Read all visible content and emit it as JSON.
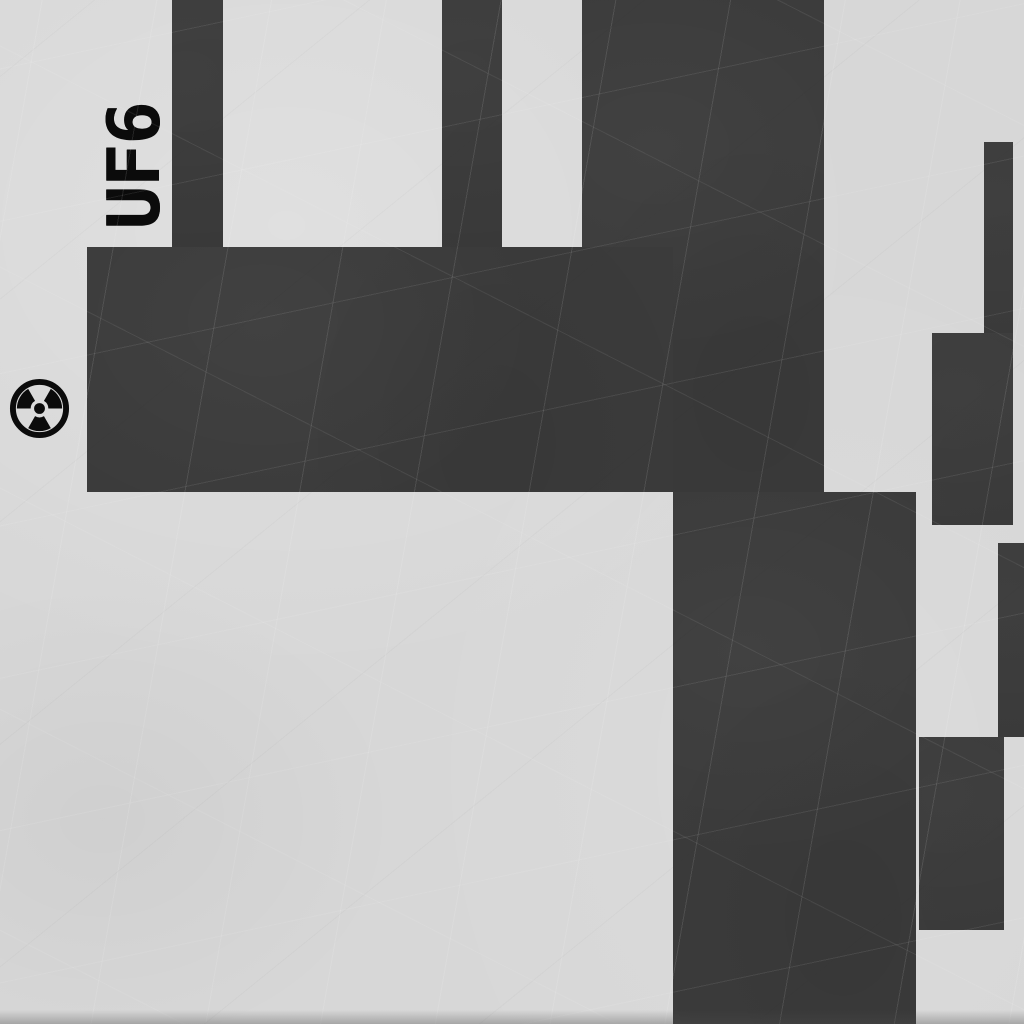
{
  "scene": {
    "label": "UF6",
    "colors": {
      "background": "#d7d7d7",
      "block": "#3b3b3b",
      "ink": "#0b0b0b"
    },
    "label_anchor": {
      "x": 134,
      "y": 166
    },
    "radiation_icon": {
      "x": 8,
      "y": 377,
      "size": 63
    },
    "blocks": [
      {
        "x": 172,
        "y": 0,
        "w": 51,
        "h": 247
      },
      {
        "x": 442,
        "y": 0,
        "w": 60,
        "h": 247
      },
      {
        "x": 582,
        "y": 0,
        "w": 242,
        "h": 492
      },
      {
        "x": 87,
        "y": 247,
        "w": 586,
        "h": 245
      },
      {
        "x": 673,
        "y": 492,
        "w": 243,
        "h": 532
      },
      {
        "x": 984,
        "y": 142,
        "w": 29,
        "h": 191
      },
      {
        "x": 932,
        "y": 333,
        "w": 81,
        "h": 192
      },
      {
        "x": 998,
        "y": 543,
        "w": 26,
        "h": 194
      },
      {
        "x": 919,
        "y": 737,
        "w": 85,
        "h": 193
      }
    ]
  }
}
